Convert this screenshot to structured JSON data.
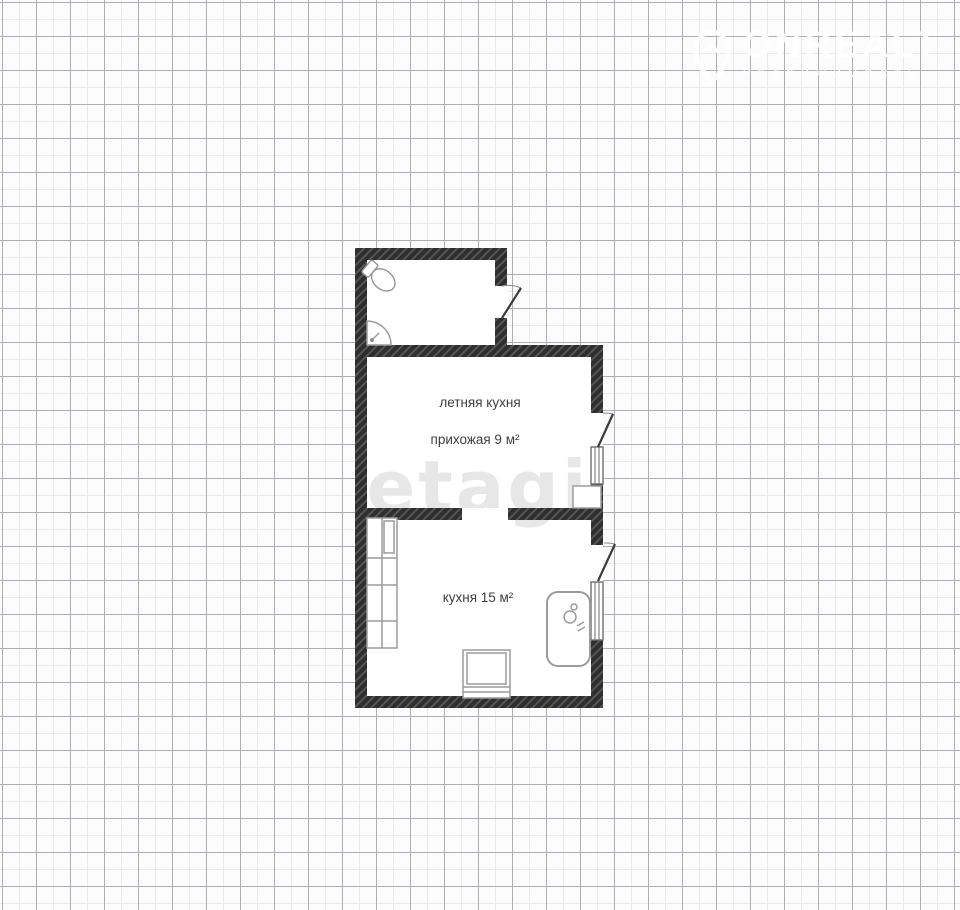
{
  "logo": {
    "brand": "ONREALT",
    "subtitle": "НЕДВИЖИМОСТЬ",
    "icon": "house-pin-icon",
    "color": "#ffffff"
  },
  "watermark": {
    "text": "etagi",
    "color": "#e7e7e7"
  },
  "grid": {
    "background": "#fcfcfc",
    "major_line": "#aeaeb4",
    "minor_line": "#eaeaee"
  },
  "floorplan": {
    "labels": {
      "summer_kitchen": "летняя кухня",
      "hallway": "прихожая 9 м²",
      "kitchen": "кухня 15 м²"
    },
    "colors": {
      "wall": "#2e2e2e",
      "wall_stripe": "#555555",
      "fixture": "#9b9b9b",
      "door": "#3c3c3c",
      "window_frame": "#6e6e6e",
      "text": "#3f3f3f"
    },
    "fixtures": [
      "toilet-icon",
      "corner-sink-icon",
      "cabinets-icon",
      "bathtub-icon",
      "stove-icon"
    ]
  }
}
